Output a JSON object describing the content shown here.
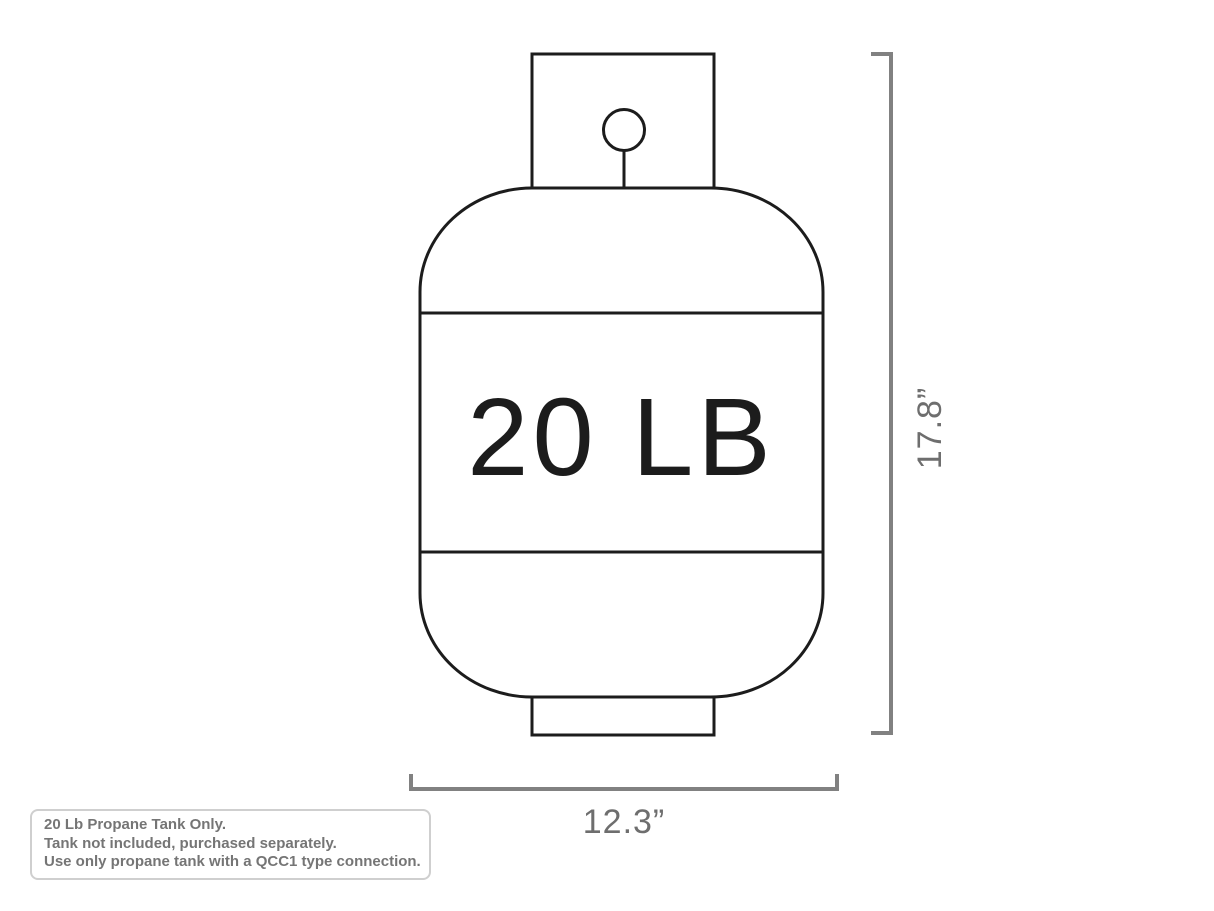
{
  "drawing": {
    "tank_label": "20 LB",
    "height_dimension": "17.8”",
    "width_dimension": "12.3”"
  },
  "note": {
    "lines": [
      "20 Lb Propane Tank Only.",
      "Tank not included, purchased separately.",
      "Use only propane tank with a QCC1 type connection."
    ]
  },
  "colors": {
    "background": "#ffffff",
    "tank_outline": "#1c1c1c",
    "dimension_line": "#818181",
    "dimension_text": "#6e6e6e",
    "note_text": "#757575",
    "note_border": "#cfcfcf"
  }
}
